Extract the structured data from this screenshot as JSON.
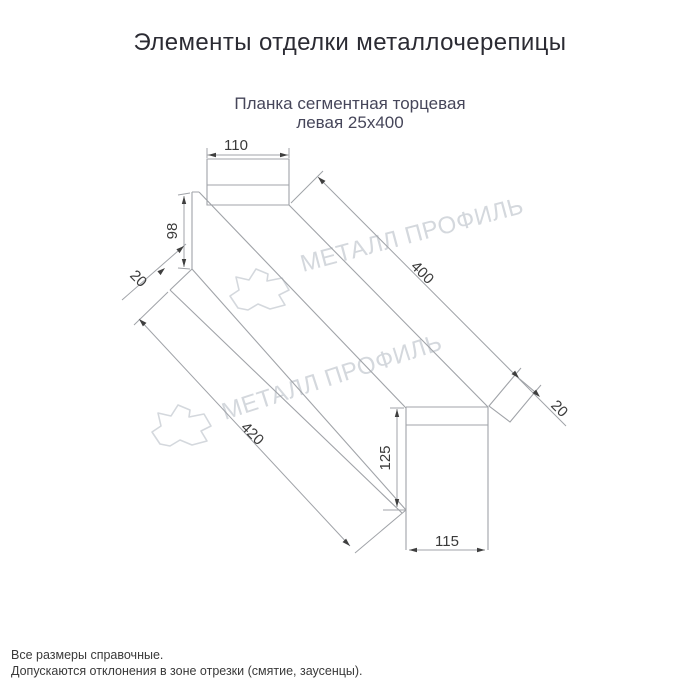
{
  "header": {
    "title": "Элементы отделки металлочерепицы"
  },
  "drawing": {
    "subtitle": {
      "line1": "Планка сегментная торцевая",
      "line2": "левая 25х400"
    },
    "dimensions": {
      "top_width": "110",
      "left_height": "98",
      "left_fold_width": "20",
      "top_length": "400",
      "bottom_length": "420",
      "right_height": "125",
      "bottom_width": "115",
      "right_fold_width": "20"
    },
    "watermark": {
      "text": "МЕТАЛЛ ПРОФИЛЬ",
      "logo": "metall-profil-cloud-logo"
    }
  },
  "footer": {
    "line1": "Все размеры справочные.",
    "line2": "Допускаются отклонения в зоне отрезки (смятие, заусенцы)."
  },
  "colors": {
    "background": "#ffffff",
    "title_text": "#2b2b33",
    "subtitle_text": "#46465a",
    "dimension_text": "#3a3a3a",
    "drawing_lines": "#a0a3a8",
    "arrowheads": "#3f3f3f",
    "watermark": "#d4d8dd",
    "footer_text": "#3a3a3a"
  }
}
